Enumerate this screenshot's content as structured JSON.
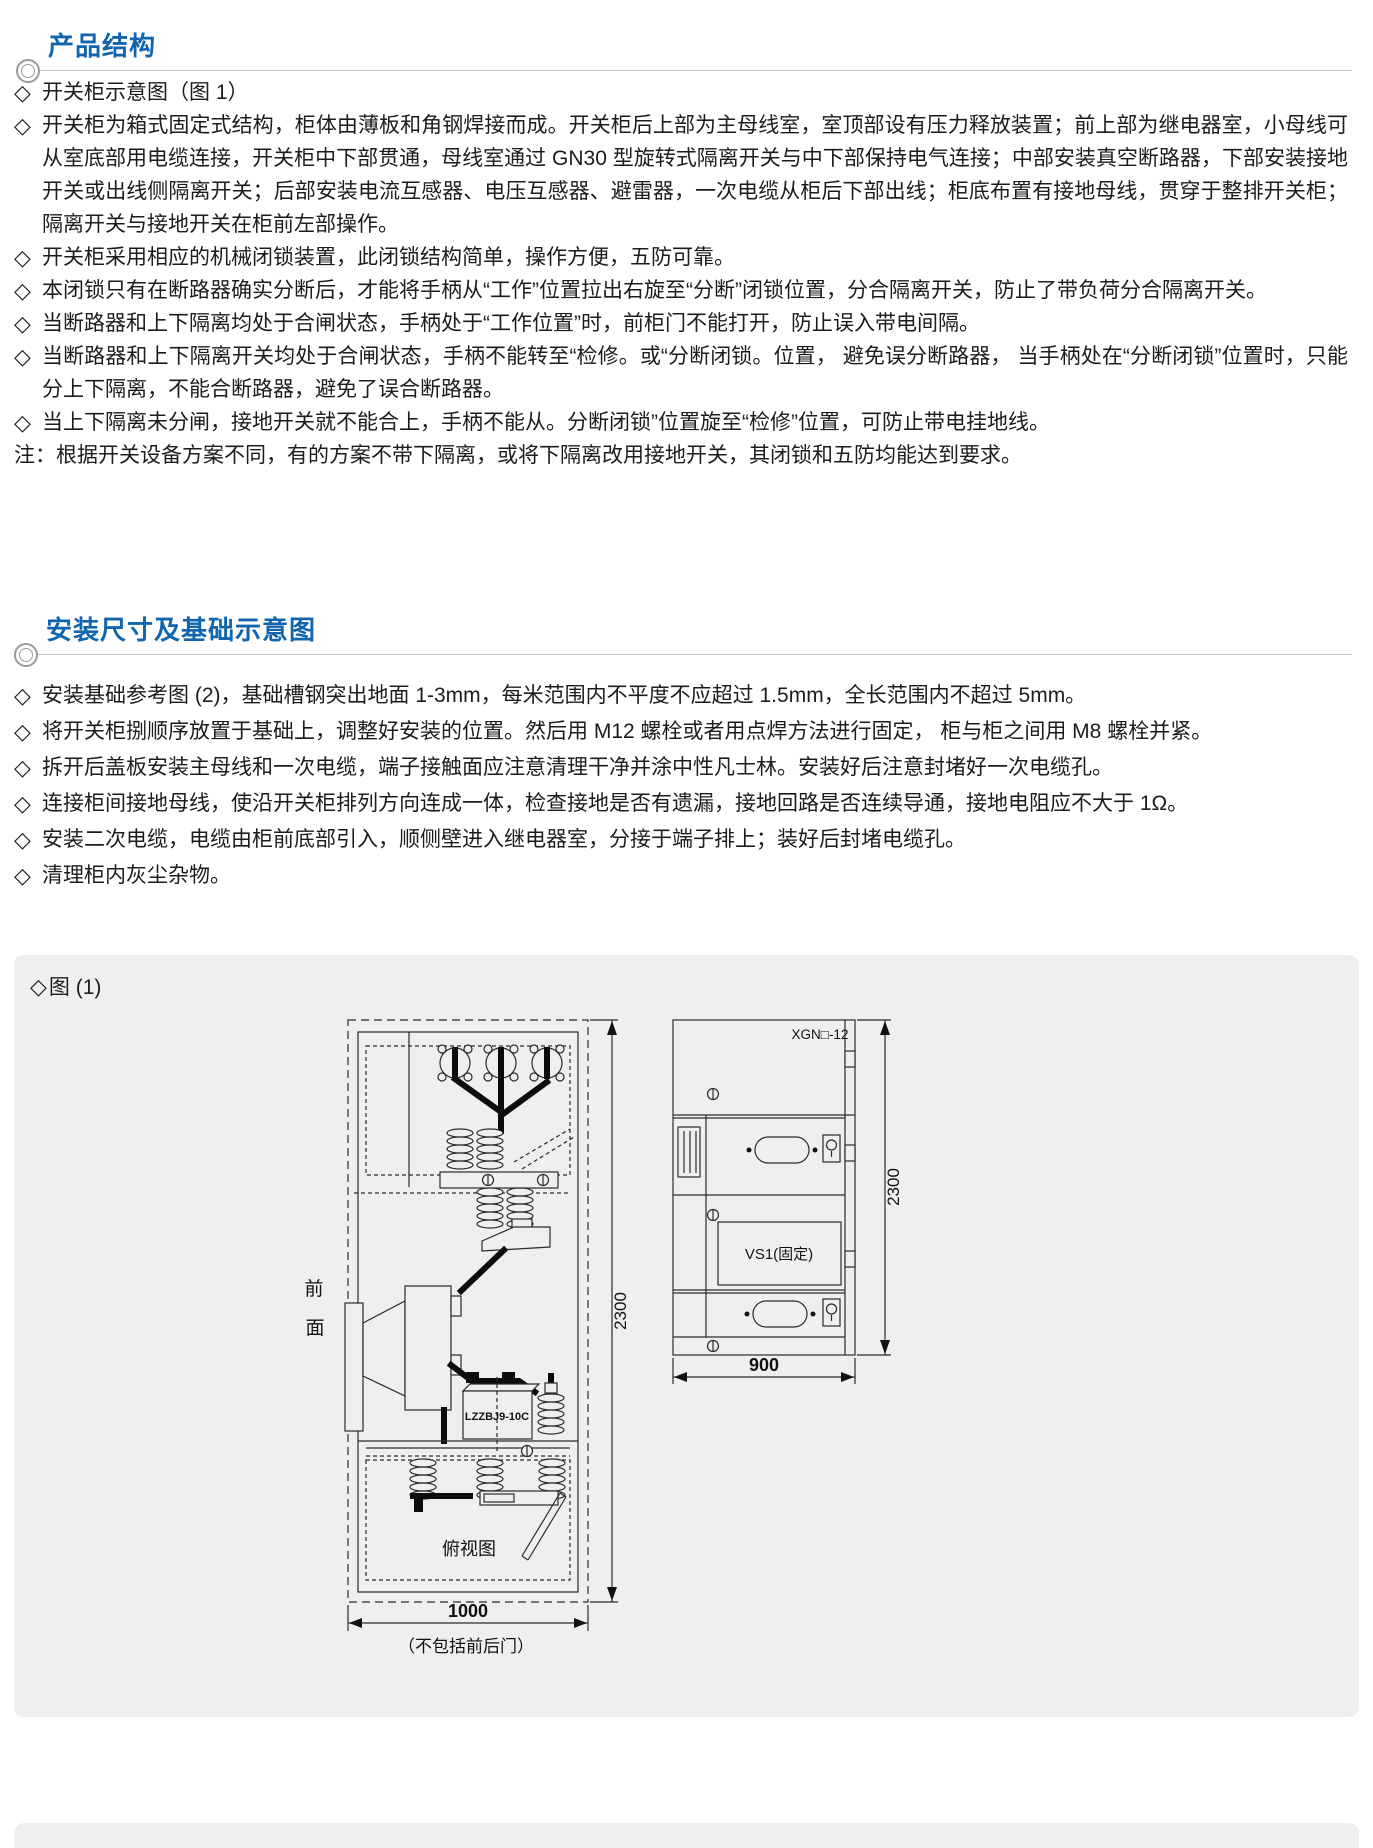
{
  "sections": [
    {
      "title": "产品结构",
      "bullets": [
        {
          "marker": "◇",
          "text": "开关柜示意图（图 1）"
        },
        {
          "marker": "◇",
          "text": "开关柜为箱式固定式结构，柜体由薄板和角钢焊接而成。开关柜后上部为主母线室，室顶部设有压力释放装置；前上部为继电器室，小母线可从室底部用电缆连接，开关柜中下部贯通，母线室通过 GN30 型旋转式隔离开关与中下部保持电气连接；中部安装真空断路器，下部安装接地开关或出线侧隔离开关；后部安装电流互感器、电压互感器、避雷器，一次电缆从柜后下部出线；柜底布置有接地母线，贯穿于整排开关柜；隔离开关与接地开关在柜前左部操作。"
        },
        {
          "marker": "◇",
          "text": "开关柜采用相应的机械闭锁装置，此闭锁结构简单，操作方便，五防可靠。"
        },
        {
          "marker": "◇",
          "text": "本闭锁只有在断路器确实分断后，才能将手柄从“工作”位置拉出右旋至“分断”闭锁位置，分合隔离开关，防止了带负荷分合隔离开关。"
        },
        {
          "marker": "◇",
          "text": "当断路器和上下隔离均处于合闸状态，手柄处于“工作位置”时，前柜门不能打开，防止误入带电间隔。"
        },
        {
          "marker": "◇",
          "text": "当断路器和上下隔离开关均处于合闸状态，手柄不能转至“检修。或“分断闭锁。位置， 避免误分断路器， 当手柄处在“分断闭锁”位置时，只能分上下隔离，不能合断路器，避免了误合断路器。"
        },
        {
          "marker": "◇",
          "text": "当上下隔离未分闸，接地开关就不能合上，手柄不能从。分断闭锁”位置旋至“检修”位置，可防止带电挂地线。"
        }
      ],
      "note": "注：根据开关设备方案不同，有的方案不带下隔离，或将下隔离改用接地开关，其闭锁和五防均能达到要求。"
    },
    {
      "title": "安装尺寸及基础示意图",
      "bullets": [
        {
          "marker": "◇",
          "text": "安装基础参考图 (2)，基础槽钢突出地面 1-3mm，每米范围内不平度不应超过 1.5mm，全长范围内不超过 5mm。"
        },
        {
          "marker": "◇",
          "text": "将开关柜捌顺序放置于基础上，调整好安装的位置。然后用 M12 螺栓或者用点焊方法进行固定， 柜与柜之间用 M8 螺栓并紧。"
        },
        {
          "marker": "◇",
          "text": "拆开后盖板安装主母线和一次电缆，端子接触面应注意清理干净并涂中性凡士林。安装好后注意封堵好一次电缆孔。"
        },
        {
          "marker": "◇",
          "text": "连接柜间接地母线，使沿开关柜排列方向连成一体，检查接地是否有遗漏，接地回路是否连续导通，接地电阻应不大于 1Ω。"
        },
        {
          "marker": "◇",
          "text": "安装二次电缆，电缆由柜前底部引入，顺侧壁进入继电器室，分接于端子排上；装好后封堵电缆孔。"
        },
        {
          "marker": "◇",
          "text": "清理柜内灰尘杂物。"
        }
      ]
    }
  ],
  "figure": {
    "marker": "◇",
    "caption": "图 (1)",
    "left": {
      "front_top": "前",
      "front_bottom": "面",
      "ct_label": "LZZBJ9-10C",
      "top_view_label": "俯视图",
      "dim_height": "2300",
      "dim_width": "1000",
      "dim_note": "（不包括前后门）"
    },
    "right": {
      "model": "XGN□-12",
      "vcb": "VS1(固定)",
      "dim_height": "2300",
      "dim_width": "900"
    }
  },
  "colors": {
    "accent": "#1065ae",
    "panel_bg": "#efeff0"
  }
}
